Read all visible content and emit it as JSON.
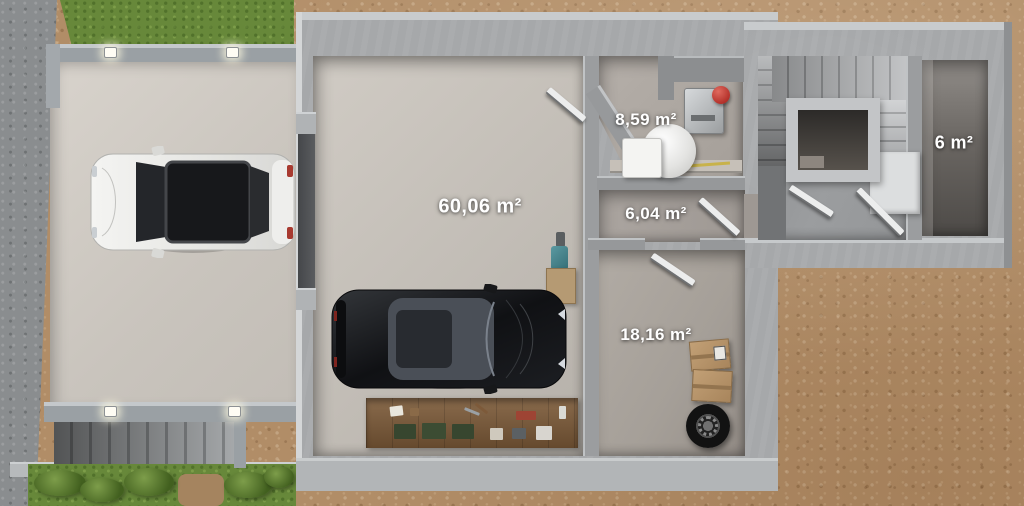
{
  "scene": {
    "kind": "3d-floor-plan-top-view",
    "level": "garage-basement-level"
  },
  "rooms": [
    {
      "id": "garage",
      "area_label": "60,06 m²"
    },
    {
      "id": "utility-room",
      "area_label": "8,59 m²"
    },
    {
      "id": "hallway",
      "area_label": "6,04 m²"
    },
    {
      "id": "storage-room",
      "area_label": "18,16 m²"
    },
    {
      "id": "cellar",
      "area_label": "6 m²"
    }
  ],
  "colors": {
    "wall_gray": "#a6a8aa",
    "wall_top_face": "#c8cbcd",
    "garage_floor": "#c2bdb6",
    "driveway_concrete": "#d4cfc8",
    "dirt_ground": "#b18d67",
    "asphalt_road": "#8a8d8f",
    "grass": "#67883a",
    "label_text": "#ffffff",
    "stair_void": "#2c2a28",
    "workbench_wood": "#7c5a38",
    "cardboard": "#b6946b",
    "expansion_tank_red": "#b4322b"
  }
}
